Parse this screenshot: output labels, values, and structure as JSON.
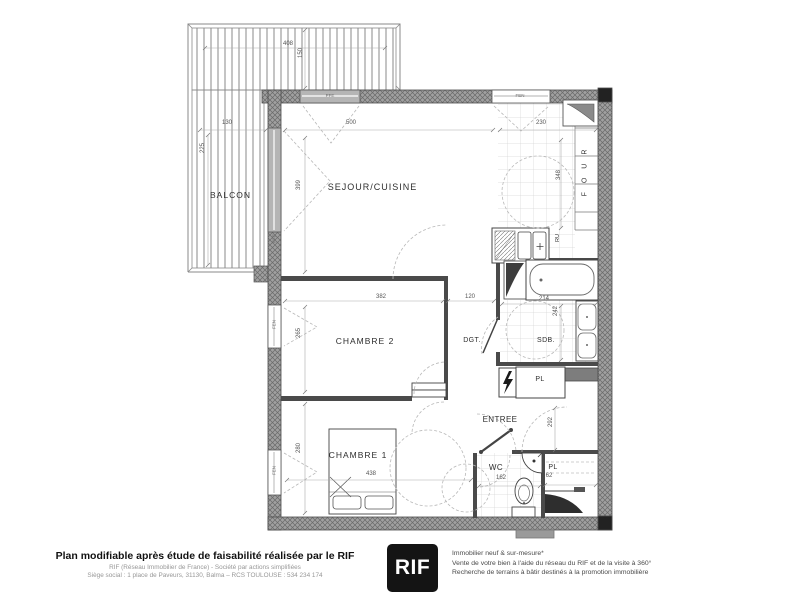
{
  "rooms": {
    "balcon": "BALCON",
    "sejour": "SEJOUR/CUISINE",
    "chambre2": "CHAMBRE 2",
    "dgt": "DGT.",
    "sdb": "SDB.",
    "pl1": "PL",
    "entree": "ENTREE",
    "chambre1": "CHAMBRE 1",
    "wc": "WC",
    "pl2": "PL"
  },
  "openings": {
    "pfe_top": "PFE",
    "fen_top": "FEN",
    "pfe_balcon": "PFE",
    "fen_chambre2": "FEN",
    "fen_chambre1": "FEN"
  },
  "kitchen": {
    "oven": "FOUR",
    "ru": "RU"
  },
  "dims": {
    "balcon_width": "408",
    "balcon_return": "150",
    "balcon_width2": "130",
    "balcon_depth": "225",
    "sejour_width": "500",
    "cuisine_width": "230",
    "sejour_depth": "399",
    "cuisine_depth": "348",
    "chambre2_width": "382",
    "dgt_width": "120",
    "sdb_width": "214",
    "sdb_depth": "242",
    "chambre2_depth": "265",
    "chambre1_depth": "280",
    "chambre1_width": "438",
    "wc_width": "162",
    "pl_width": "62",
    "entree_depth": "292"
  },
  "footer": {
    "left_bold": "Plan modifiable après étude de faisabilité réalisée par le RIF",
    "left_line1": "RIF (Réseau Immobilier de France) - Société par actions simplifiées",
    "left_line2": "Siège social : 1 place de Paveurs, 31130, Balma – RCS TOULOUSE : 534 234 174",
    "logo": "RIF",
    "right_line1": "Immobilier neuf & sur-mesure*",
    "right_line2": "Vente de votre bien à l'aide du réseau du RIF et de la visite à 360°",
    "right_line3": "Recherche de terrains à bâtir destinés à la promotion immobilière"
  },
  "colors": {
    "wall": "#9c9c9c",
    "line": "#444444",
    "dashed": "#b8b8b8",
    "logo_bg": "#141414"
  }
}
